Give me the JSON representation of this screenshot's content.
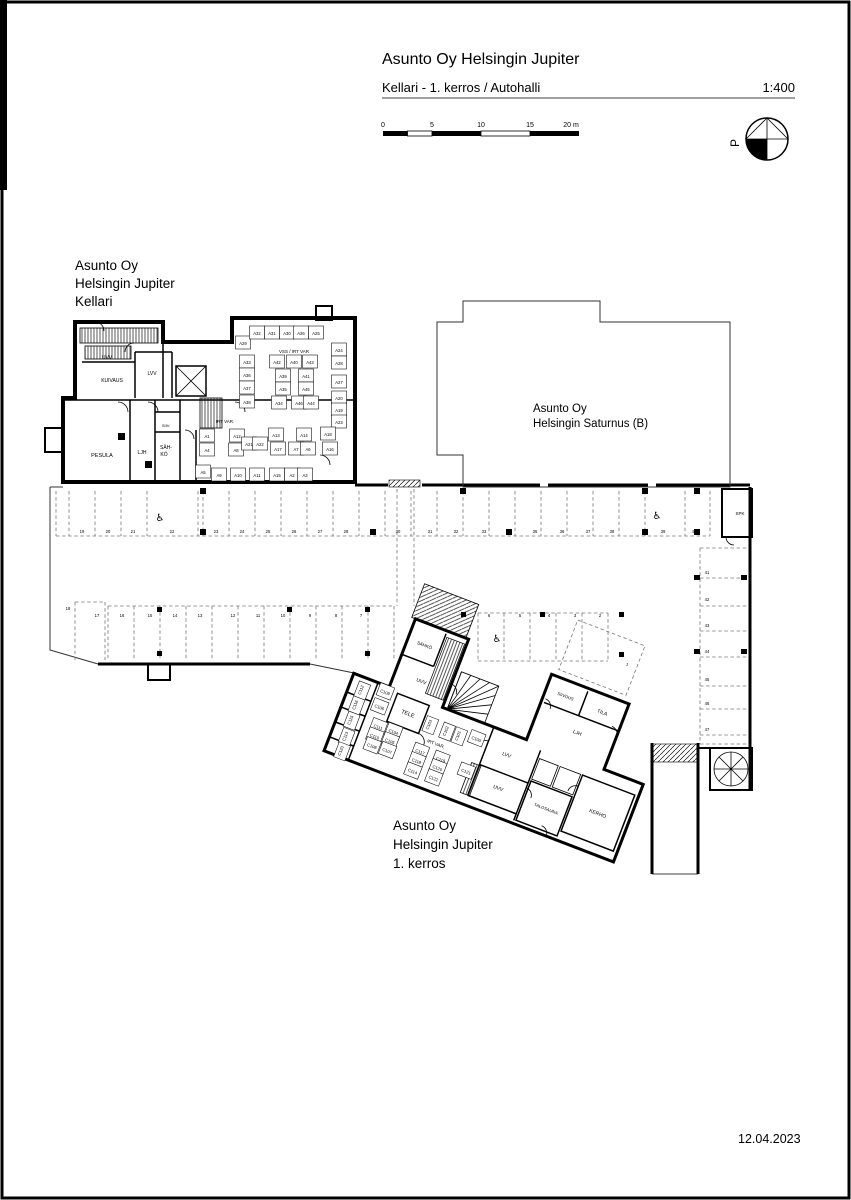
{
  "title_block": {
    "title": "Asunto Oy Helsingin Jupiter",
    "subtitle": "Kellari - 1. kerros / Autohalli",
    "scale": "1:400"
  },
  "scale_bar": {
    "ticks": [
      "0",
      "5",
      "10",
      "15",
      "20 m"
    ]
  },
  "north": {
    "label": "P"
  },
  "date": "12.04.2023",
  "annotations": [
    {
      "id": "kellari-label",
      "x": 75,
      "y": 270,
      "size": 13.5,
      "lh": 18,
      "lines": [
        "Asunto Oy",
        "Helsingin Jupiter",
        "Kellari"
      ]
    },
    {
      "id": "saturnus-label",
      "x": 533,
      "y": 412,
      "size": 11.5,
      "lh": 15,
      "lines": [
        "Asunto Oy",
        "Helsingin Saturnus (B)"
      ]
    },
    {
      "id": "kerros1-label",
      "x": 393,
      "y": 830,
      "size": 13.5,
      "lh": 19,
      "lines": [
        "Asunto Oy",
        "Helsingin Jupiter",
        "1. kerros"
      ]
    }
  ],
  "plan_labels": [
    {
      "t": "UVV",
      "x": 107,
      "y": 359,
      "s": 5,
      "n": "room-label-uvv-kellari"
    },
    {
      "t": "KUIVAUS",
      "x": 112,
      "y": 382,
      "s": 5,
      "n": "room-label-kuivaus"
    },
    {
      "t": "LVV",
      "x": 152,
      "y": 375,
      "s": 5,
      "n": "room-label-lvv-kellari"
    },
    {
      "t": "PESULA",
      "x": 102,
      "y": 457,
      "s": 5.5,
      "n": "room-label-pesula"
    },
    {
      "t": "LJH",
      "x": 142,
      "y": 454,
      "s": 5,
      "n": "room-label-ljh-kellari"
    },
    {
      "t": "SÄH-",
      "x": 166,
      "y": 449,
      "s": 5,
      "n": "room-label-sahko-line1"
    },
    {
      "t": "KÖ",
      "x": 164,
      "y": 456,
      "s": 5,
      "n": "room-label-sahko-line2"
    },
    {
      "t": "SIIV.",
      "x": 166,
      "y": 427,
      "s": 4,
      "n": "room-label-siiv"
    },
    {
      "t": "IRT VAR.",
      "x": 225,
      "y": 423,
      "s": 4.5,
      "n": "room-label-irtvar-kellari"
    },
    {
      "t": "VSS / IRT VAR",
      "x": 294,
      "y": 353,
      "s": 4.5,
      "n": "room-label-vss-irtvar"
    },
    {
      "t": "A29",
      "x": 243,
      "y": 345,
      "c": 1
    },
    {
      "t": "A32",
      "x": 257,
      "y": 335,
      "c": 1
    },
    {
      "t": "A31",
      "x": 272,
      "y": 335,
      "c": 1
    },
    {
      "t": "A30",
      "x": 287,
      "y": 335,
      "c": 1
    },
    {
      "t": "A26",
      "x": 301,
      "y": 335,
      "c": 1
    },
    {
      "t": "A25",
      "x": 316,
      "y": 335,
      "c": 1
    },
    {
      "t": "A24",
      "x": 339,
      "y": 352,
      "c": 1
    },
    {
      "t": "A28",
      "x": 339,
      "y": 365,
      "c": 1
    },
    {
      "t": "A27",
      "x": 339,
      "y": 384,
      "c": 1
    },
    {
      "t": "A20",
      "x": 339,
      "y": 400,
      "c": 1
    },
    {
      "t": "A19",
      "x": 339,
      "y": 412,
      "c": 1
    },
    {
      "t": "A23",
      "x": 339,
      "y": 424,
      "c": 1
    },
    {
      "t": "A18",
      "x": 328,
      "y": 436,
      "c": 1
    },
    {
      "t": "A33",
      "x": 247,
      "y": 364,
      "c": 1
    },
    {
      "t": "A36",
      "x": 247,
      "y": 377,
      "c": 1
    },
    {
      "t": "A37",
      "x": 247,
      "y": 390,
      "c": 1
    },
    {
      "t": "A38",
      "x": 247,
      "y": 404,
      "c": 1
    },
    {
      "t": "A42",
      "x": 277,
      "y": 364,
      "c": 1
    },
    {
      "t": "A40",
      "x": 294,
      "y": 364,
      "c": 1
    },
    {
      "t": "A43",
      "x": 310,
      "y": 364,
      "c": 1
    },
    {
      "t": "A39",
      "x": 283,
      "y": 378,
      "c": 1
    },
    {
      "t": "A41",
      "x": 306,
      "y": 378,
      "c": 1
    },
    {
      "t": "A35",
      "x": 283,
      "y": 391,
      "c": 1
    },
    {
      "t": "A45",
      "x": 306,
      "y": 391,
      "c": 1
    },
    {
      "t": "A34",
      "x": 279,
      "y": 405,
      "c": 1
    },
    {
      "t": "A46",
      "x": 299,
      "y": 405,
      "c": 1
    },
    {
      "t": "A44",
      "x": 311,
      "y": 405,
      "c": 1
    },
    {
      "t": "A1",
      "x": 207,
      "y": 438,
      "c": 1
    },
    {
      "t": "A4",
      "x": 207,
      "y": 452,
      "c": 1
    },
    {
      "t": "A5",
      "x": 203,
      "y": 474,
      "c": 1
    },
    {
      "t": "A12",
      "x": 237,
      "y": 438,
      "c": 1
    },
    {
      "t": "A8",
      "x": 236,
      "y": 452,
      "c": 1
    },
    {
      "t": "A21",
      "x": 249,
      "y": 446,
      "c": 1
    },
    {
      "t": "A22",
      "x": 260,
      "y": 446,
      "c": 1
    },
    {
      "t": "A13",
      "x": 276,
      "y": 437,
      "c": 1
    },
    {
      "t": "A17",
      "x": 278,
      "y": 451,
      "c": 1
    },
    {
      "t": "A14",
      "x": 304,
      "y": 437,
      "c": 1
    },
    {
      "t": "A7",
      "x": 296,
      "y": 451,
      "c": 1
    },
    {
      "t": "A6",
      "x": 308,
      "y": 451,
      "c": 1
    },
    {
      "t": "A16",
      "x": 330,
      "y": 451,
      "c": 1
    },
    {
      "t": "A9",
      "x": 219,
      "y": 477,
      "c": 1
    },
    {
      "t": "A10",
      "x": 238,
      "y": 477,
      "c": 1
    },
    {
      "t": "A11",
      "x": 257,
      "y": 477,
      "c": 1
    },
    {
      "t": "A15",
      "x": 277,
      "y": 477,
      "c": 1
    },
    {
      "t": "A2",
      "x": 292,
      "y": 477,
      "c": 1
    },
    {
      "t": "A3",
      "x": 305,
      "y": 477,
      "c": 1
    },
    {
      "t": "19",
      "x": 82,
      "y": 533,
      "n": "parking-stall-19"
    },
    {
      "t": "20",
      "x": 108,
      "y": 533,
      "n": "parking-stall-20"
    },
    {
      "t": "21",
      "x": 133,
      "y": 533,
      "n": "parking-stall-21"
    },
    {
      "t": "22",
      "x": 172,
      "y": 533,
      "n": "parking-stall-22"
    },
    {
      "t": "23",
      "x": 216,
      "y": 533,
      "n": "parking-stall-23"
    },
    {
      "t": "24",
      "x": 242,
      "y": 533,
      "n": "parking-stall-24"
    },
    {
      "t": "25",
      "x": 268,
      "y": 533,
      "n": "parking-stall-25"
    },
    {
      "t": "26",
      "x": 294,
      "y": 533,
      "n": "parking-stall-26"
    },
    {
      "t": "27",
      "x": 320,
      "y": 533,
      "n": "parking-stall-27"
    },
    {
      "t": "28",
      "x": 346,
      "y": 533,
      "n": "parking-stall-28"
    },
    {
      "t": "29",
      "x": 372,
      "y": 533,
      "n": "parking-stall-29"
    },
    {
      "t": "30",
      "x": 398,
      "y": 533,
      "n": "parking-stall-30"
    },
    {
      "t": "31",
      "x": 430,
      "y": 533,
      "n": "parking-stall-31"
    },
    {
      "t": "32",
      "x": 456,
      "y": 533,
      "n": "parking-stall-32"
    },
    {
      "t": "33",
      "x": 484,
      "y": 533,
      "n": "parking-stall-33"
    },
    {
      "t": "34",
      "x": 509,
      "y": 533,
      "n": "parking-stall-34"
    },
    {
      "t": "35",
      "x": 535,
      "y": 533,
      "n": "parking-stall-35"
    },
    {
      "t": "36",
      "x": 562,
      "y": 533,
      "n": "parking-stall-36"
    },
    {
      "t": "37",
      "x": 588,
      "y": 533,
      "n": "parking-stall-37"
    },
    {
      "t": "38",
      "x": 612,
      "y": 533,
      "n": "parking-stall-38"
    },
    {
      "t": "39",
      "x": 663,
      "y": 533,
      "n": "parking-stall-39"
    },
    {
      "t": "40",
      "x": 694,
      "y": 533,
      "n": "parking-stall-40"
    },
    {
      "t": "18",
      "x": 68,
      "y": 610,
      "n": "parking-stall-18"
    },
    {
      "t": "17",
      "x": 97,
      "y": 617,
      "n": "parking-stall-17"
    },
    {
      "t": "16",
      "x": 122,
      "y": 617,
      "n": "parking-stall-16"
    },
    {
      "t": "15",
      "x": 150,
      "y": 617,
      "n": "parking-stall-15"
    },
    {
      "t": "14",
      "x": 175,
      "y": 617,
      "n": "parking-stall-14"
    },
    {
      "t": "13",
      "x": 200,
      "y": 617,
      "n": "parking-stall-13"
    },
    {
      "t": "12",
      "x": 233,
      "y": 617,
      "n": "parking-stall-12"
    },
    {
      "t": "11",
      "x": 258,
      "y": 617,
      "n": "parking-stall-11"
    },
    {
      "t": "10",
      "x": 283,
      "y": 617,
      "n": "parking-stall-10"
    },
    {
      "t": "9",
      "x": 310,
      "y": 617,
      "n": "parking-stall-9"
    },
    {
      "t": "8",
      "x": 336,
      "y": 617,
      "n": "parking-stall-8"
    },
    {
      "t": "7",
      "x": 361,
      "y": 617,
      "n": "parking-stall-7"
    },
    {
      "t": "6",
      "x": 489,
      "y": 617,
      "n": "parking-stall-6"
    },
    {
      "t": "5",
      "x": 520,
      "y": 617,
      "n": "parking-stall-5"
    },
    {
      "t": "4",
      "x": 549,
      "y": 617,
      "n": "parking-stall-4"
    },
    {
      "t": "3",
      "x": 575,
      "y": 617,
      "n": "parking-stall-3"
    },
    {
      "t": "2",
      "x": 600,
      "y": 617,
      "n": "parking-stall-2"
    },
    {
      "t": "41",
      "x": 707,
      "y": 574,
      "n": "parking-stall-41"
    },
    {
      "t": "42",
      "x": 707,
      "y": 601,
      "n": "parking-stall-42"
    },
    {
      "t": "43",
      "x": 707,
      "y": 627,
      "n": "parking-stall-43"
    },
    {
      "t": "44",
      "x": 707,
      "y": 653,
      "n": "parking-stall-44"
    },
    {
      "t": "45",
      "x": 707,
      "y": 681,
      "n": "parking-stall-45"
    },
    {
      "t": "46",
      "x": 707,
      "y": 705,
      "n": "parking-stall-46"
    },
    {
      "t": "47",
      "x": 707,
      "y": 731,
      "n": "parking-stall-47"
    },
    {
      "t": "SPK",
      "x": 740,
      "y": 515,
      "s": 4.5,
      "n": "room-label-spk"
    },
    {
      "t": "♿",
      "x": 160,
      "y": 521,
      "s": 10,
      "n": "wheelchair-icon"
    },
    {
      "t": "♿",
      "x": 657,
      "y": 519,
      "s": 10,
      "n": "wheelchair-icon"
    },
    {
      "t": "♿",
      "x": 497,
      "y": 642,
      "s": 10,
      "n": "wheelchair-icon"
    },
    {
      "t": "1",
      "x": 252,
      "y": -110,
      "g": "b",
      "n": "parking-stall-1"
    },
    {
      "t": "SÄHKÖ",
      "x": 56,
      "y": -55,
      "s": 4.5,
      "g": "b",
      "n": "room-label-sahko-1krs"
    },
    {
      "t": "UVV",
      "x": 66,
      "y": -20,
      "s": 5,
      "g": "b",
      "n": "room-label-uvv-1krs"
    },
    {
      "t": "TELE",
      "x": 65,
      "y": 15,
      "s": 5.5,
      "g": "b",
      "n": "room-label-tele"
    },
    {
      "t": "IRT VAR.",
      "x": 102,
      "y": 33,
      "s": 4.5,
      "g": "b",
      "n": "room-label-irtvar-1krs"
    },
    {
      "t": "LVV",
      "x": 172,
      "y": 18,
      "s": 5,
      "g": "b",
      "n": "room-label-lvv-1krs"
    },
    {
      "t": "UVV",
      "x": 176,
      "y": 52,
      "s": 5,
      "g": "b",
      "n": "room-label-uvv2-1krs"
    },
    {
      "t": "TALOSAUNA",
      "x": 228,
      "y": 54,
      "s": 4.2,
      "g": "b",
      "n": "room-label-talosauna"
    },
    {
      "t": "KERHO",
      "x": 278,
      "y": 40,
      "s": 5,
      "g": "b",
      "n": "room-label-kerho"
    },
    {
      "t": "SIIVOUS",
      "x": 206,
      "y": -58,
      "s": 4.2,
      "g": "b",
      "n": "room-label-siivous"
    },
    {
      "t": "TILA",
      "x": 246,
      "y": -56,
      "s": 5,
      "g": "b",
      "n": "room-label-tila"
    },
    {
      "t": "LJH",
      "x": 230,
      "y": -28,
      "s": 5,
      "g": "b",
      "n": "room-label-ljh-1krs"
    },
    {
      "t": "C109",
      "x": 36,
      "y": 3,
      "g": "b",
      "c": 1
    },
    {
      "t": "C106",
      "x": 36,
      "y": 19,
      "g": "b",
      "c": 1
    },
    {
      "t": "C111",
      "x": 42,
      "y": 38,
      "g": "b",
      "c": 1
    },
    {
      "t": "C104",
      "x": 58,
      "y": 37,
      "g": "b",
      "c": 1
    },
    {
      "t": "C110",
      "x": 42,
      "y": 48,
      "g": "b",
      "c": 1
    },
    {
      "t": "C105",
      "x": 58,
      "y": 47,
      "g": "b",
      "c": 1
    },
    {
      "t": "C108",
      "x": 43,
      "y": 58,
      "g": "b",
      "c": 1
    },
    {
      "t": "C107",
      "x": 59,
      "y": 57,
      "g": "b",
      "c": 1
    },
    {
      "t": "C103",
      "x": 90,
      "y": 16,
      "r": -90,
      "g": "b",
      "c": 1
    },
    {
      "t": "C102",
      "x": 108,
      "y": 16,
      "r": -90,
      "g": "b",
      "c": 1
    },
    {
      "t": "C101",
      "x": 121,
      "y": 16,
      "r": -90,
      "g": "b",
      "c": 1
    },
    {
      "t": "C100",
      "x": 138,
      "y": 14,
      "g": "b",
      "c": 1
    },
    {
      "t": "C117",
      "x": 90,
      "y": 46,
      "g": "b",
      "c": 1
    },
    {
      "t": "C119",
      "x": 112,
      "y": 46,
      "g": "b",
      "c": 1
    },
    {
      "t": "C118",
      "x": 90,
      "y": 56,
      "g": "b",
      "c": 1
    },
    {
      "t": "C120",
      "x": 112,
      "y": 55,
      "g": "b",
      "c": 1
    },
    {
      "t": "C114",
      "x": 90,
      "y": 67,
      "g": "b",
      "c": 1
    },
    {
      "t": "C122",
      "x": 112,
      "y": 66,
      "g": "b",
      "c": 1
    },
    {
      "t": "C121",
      "x": 140,
      "y": 48,
      "g": "b",
      "c": 1
    },
    {
      "t": "C112",
      "x": 14,
      "y": 8,
      "r": -90,
      "g": "b",
      "c": 1
    },
    {
      "t": "C116",
      "x": 14,
      "y": 24,
      "r": -90,
      "g": "b",
      "c": 1
    },
    {
      "t": "C115",
      "x": 15,
      "y": 40,
      "r": -90,
      "g": "b",
      "c": 1
    },
    {
      "t": "C113",
      "x": 16,
      "y": 57,
      "r": -90,
      "g": "b",
      "c": 1
    },
    {
      "t": "C123",
      "x": 17,
      "y": 72,
      "r": -90,
      "g": "b",
      "c": 1
    }
  ]
}
